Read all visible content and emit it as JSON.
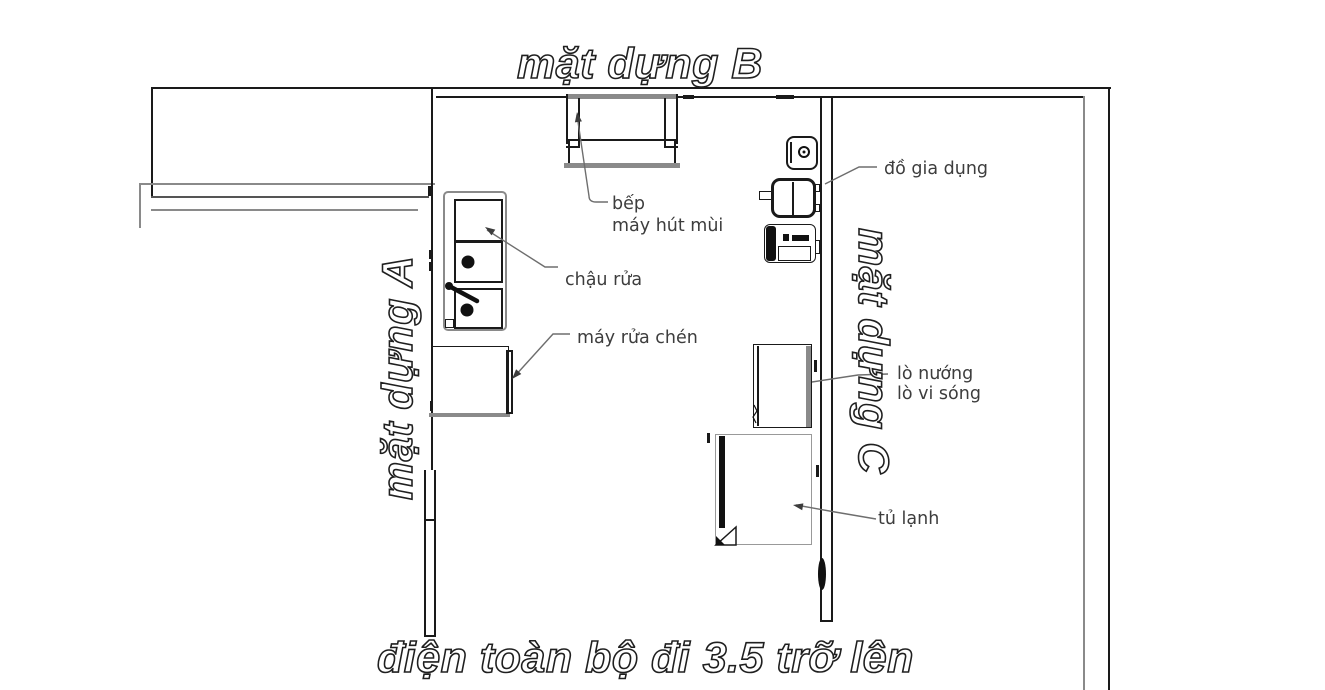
{
  "titles": {
    "top": "mặt dựng B",
    "left": "mặt dựng A",
    "right": "mặt dựng C",
    "bottom": "điện toàn bộ đi 3.5 trỡ lên"
  },
  "labels": {
    "hood_line1": "bếp",
    "hood_line2": "máy hút mùi",
    "sink": "chậu rửa",
    "dishwasher": "máy rửa chén",
    "appliances": "đồ gia dụng",
    "oven_line1": "lò nướng",
    "oven_line2": "lò vi sóng",
    "fridge": "tủ lạnh"
  },
  "colors": {
    "line": "#1a1a1a",
    "gray_line": "#8a8a8a",
    "label_text": "#3d3d3d",
    "background": "#ffffff"
  }
}
